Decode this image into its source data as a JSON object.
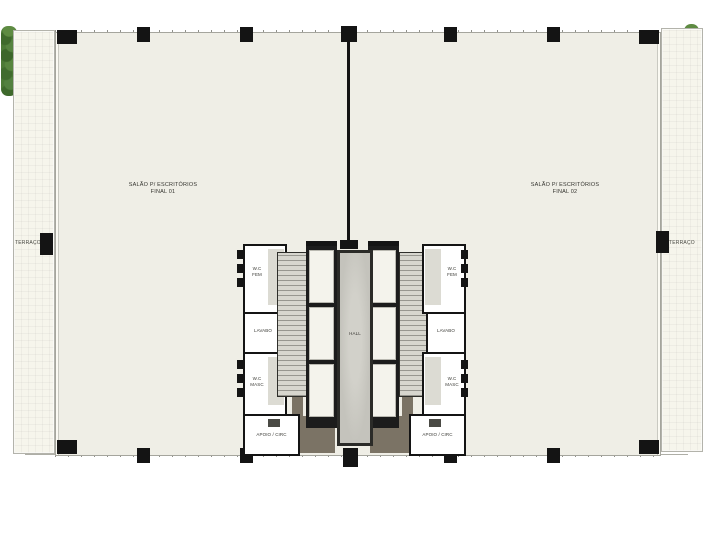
{
  "plan": {
    "offices": {
      "left": {
        "line1": "SALÃO P/ ESCRITÓRIOS",
        "line2": "FINAL 01"
      },
      "right": {
        "line1": "SALÃO P/ ESCRITÓRIOS",
        "line2": "FINAL 02"
      }
    },
    "terraces": {
      "left": "TERRAÇO",
      "right": "TERRAÇO"
    },
    "core": {
      "hall": "HALL",
      "wc_fem": {
        "line1": "W.C",
        "line2": "FEM"
      },
      "wc_masc": {
        "line1": "W.C",
        "line2": "MASC"
      },
      "lavabo": "LAVABO",
      "apoio": "APOIO / CIRC"
    },
    "colors": {
      "slab": "#efeee6",
      "terrace": "#f6f5ec",
      "wall": "#141414",
      "stair_floor": "#d7d6ce",
      "hall_floor": "#c4c3bc",
      "circulation": "#7b7365",
      "hedge_green": "#4c7a36"
    }
  }
}
